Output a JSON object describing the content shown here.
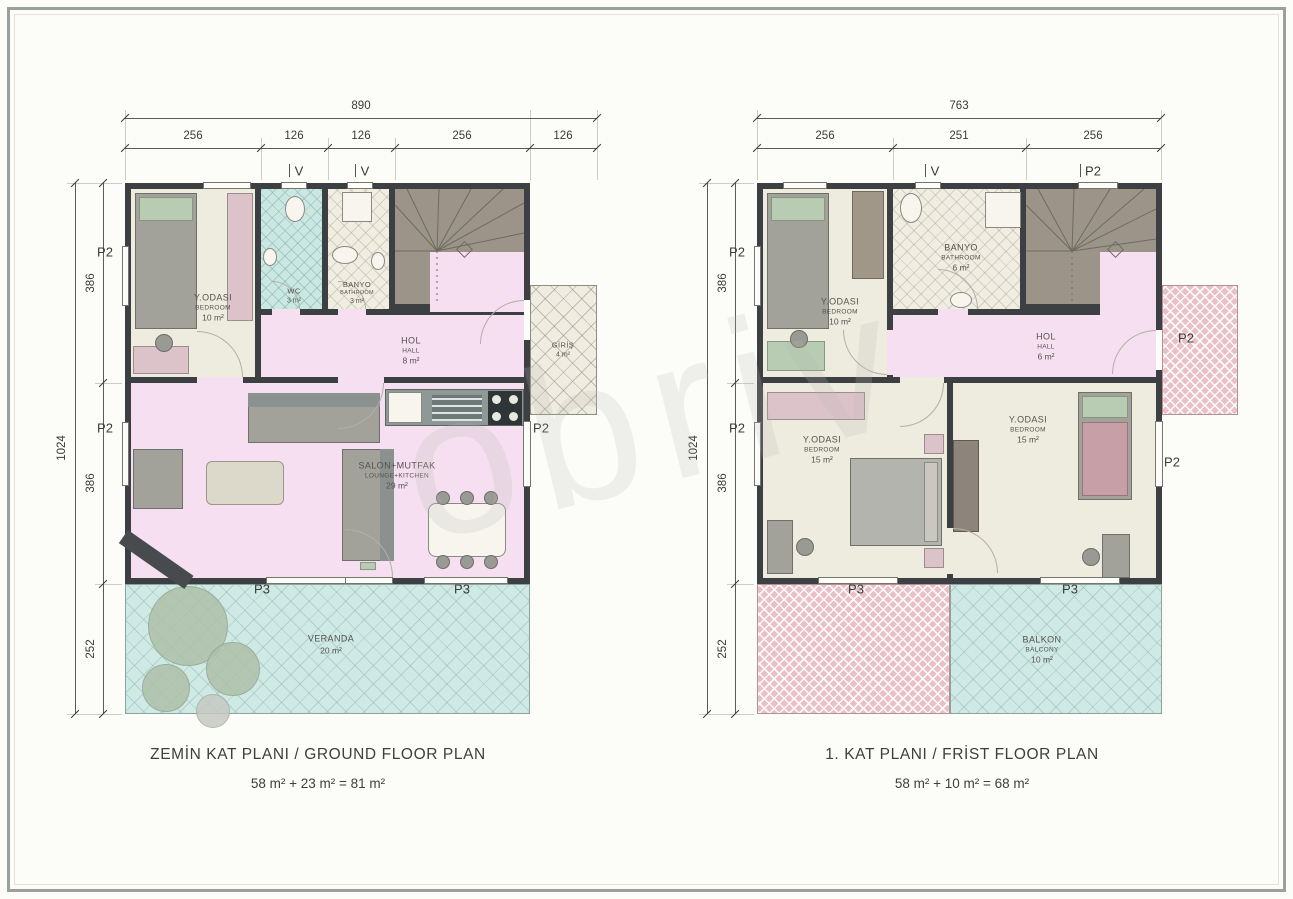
{
  "watermark": "obriv",
  "markers": {
    "p2": "P2",
    "p3": "P3",
    "v": "V"
  },
  "palette": {
    "wall": "#3d4043",
    "bedroom_floor": "#eeebdf",
    "hall_floor": "#f5dff0",
    "wet_floor_teal": "#cbe7e2",
    "veranda": "#cfe9e5",
    "balcony_roof_hatch": "#e9bfc8",
    "stairs": "#9c9488"
  },
  "plans": [
    {
      "title": "ZEMİN KAT PLANI / GROUND FLOOR PLAN",
      "subtitle": "58 m² + 23 m² = 81 m²",
      "dims": {
        "top_total": "890",
        "top_segments": [
          "256",
          "126",
          "126",
          "256",
          "126"
        ],
        "side_total": "1024",
        "side_segments": [
          "386",
          "386",
          "252"
        ]
      },
      "rooms": {
        "bedroom": {
          "name": "Y.ODASI",
          "sub": "BEDROOM",
          "area": "10 m²"
        },
        "wc": {
          "name": "WC",
          "area": "3 m²"
        },
        "bath": {
          "name": "BANYO",
          "sub": "BATHROOM",
          "area": "3 m²"
        },
        "hall": {
          "name": "HOL",
          "sub": "HALL",
          "area": "8 m²"
        },
        "salon": {
          "name": "SALON+MUTFAK",
          "sub": "LOUNGE+KITCHEN",
          "area": "29 m²"
        },
        "veranda": {
          "name": "VERANDA",
          "area": "20 m²"
        },
        "entry": {
          "name": "GİRİŞ",
          "area": "4 m²"
        }
      }
    },
    {
      "title": "1. KAT PLANI / FRİST FLOOR PLAN",
      "subtitle": "58 m² + 10 m² = 68 m²",
      "dims": {
        "top_total": "763",
        "top_segments": [
          "256",
          "251",
          "256"
        ],
        "side_total": "1024",
        "side_segments": [
          "386",
          "386",
          "252"
        ]
      },
      "rooms": {
        "bedroom": {
          "name": "Y.ODASI",
          "sub": "BEDROOM",
          "area": "10 m²"
        },
        "bath": {
          "name": "BANYO",
          "sub": "BATHROOM",
          "area": "6 m²"
        },
        "hall": {
          "name": "HOL",
          "sub": "HALL",
          "area": "6 m²"
        },
        "bedroom2": {
          "name": "Y.ODASI",
          "sub": "BEDROOM",
          "area": "15 m²"
        },
        "bedroom3": {
          "name": "Y.ODASI",
          "sub": "BEDROOM",
          "area": "15 m²"
        },
        "balcony": {
          "name": "BALKON",
          "sub": "BALCONY",
          "area": "10 m²"
        }
      }
    }
  ]
}
